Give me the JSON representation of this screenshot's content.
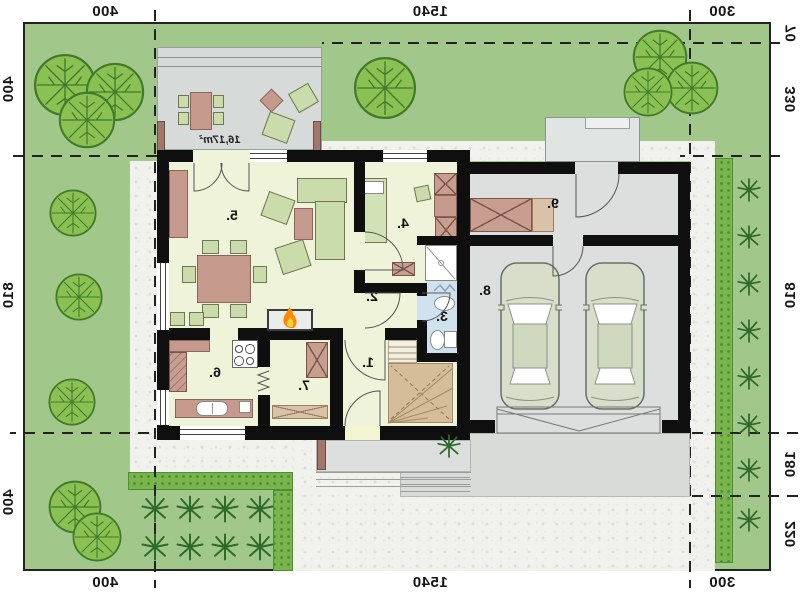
{
  "dimensions": {
    "top": [
      "400",
      "1540",
      "300"
    ],
    "bottom": [
      "400",
      "1540",
      "300"
    ],
    "left": [
      "400",
      "810",
      "400"
    ],
    "right": [
      "70",
      "330",
      "810",
      "180",
      "220"
    ]
  },
  "rooms": [
    "1.",
    "2.",
    "3.",
    "4.",
    "5.",
    "6.",
    "7.",
    "8.",
    "9."
  ],
  "terrace_area": "16,17m²",
  "note": "mirrored floor plan print",
  "colors": {
    "lawn": "#a2c78a",
    "hedge": "#79b44c",
    "tree": "#8ac152",
    "interior_floor": "#eef3d9",
    "garage_floor": "#dcdfde",
    "terrace_floor": "#d6dad9",
    "bathroom_floor": "#cfe2ee",
    "wall": "#0f0f0f",
    "paving": "#f1f1ee",
    "furniture_green": "#cadcab",
    "furniture_brown": "#c59a8c",
    "stairs": "#d6bd99",
    "flame": "#ff8a00",
    "car": "#d8deca",
    "shrub": "#2e6b28"
  }
}
